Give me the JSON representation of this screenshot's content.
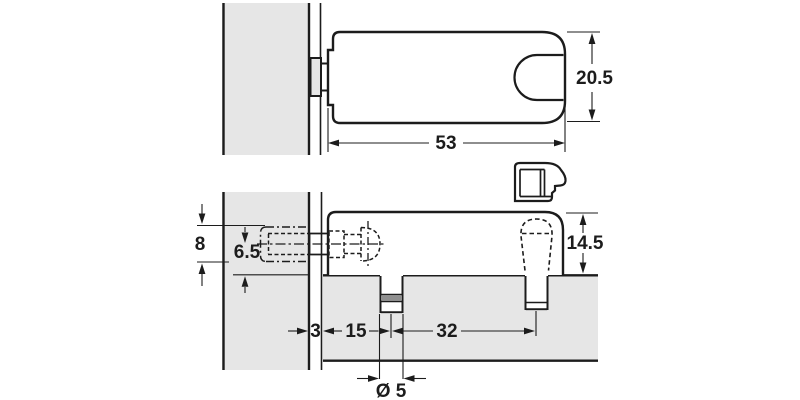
{
  "colors": {
    "line": "#1c1c1c",
    "panel_fill": "#e6e6e6",
    "dowel_band": "#8f8f8f",
    "background": "#ffffff"
  },
  "dims": {
    "body_length": "53",
    "body_width": "20.5",
    "body_height": "14.5",
    "hole_diameter": "8",
    "hole_center_height": "6.5",
    "panel_gap": "3",
    "edge_to_first_dowel": "15",
    "dowel_spacing": "32",
    "dowel_diameter": "Ø 5"
  }
}
